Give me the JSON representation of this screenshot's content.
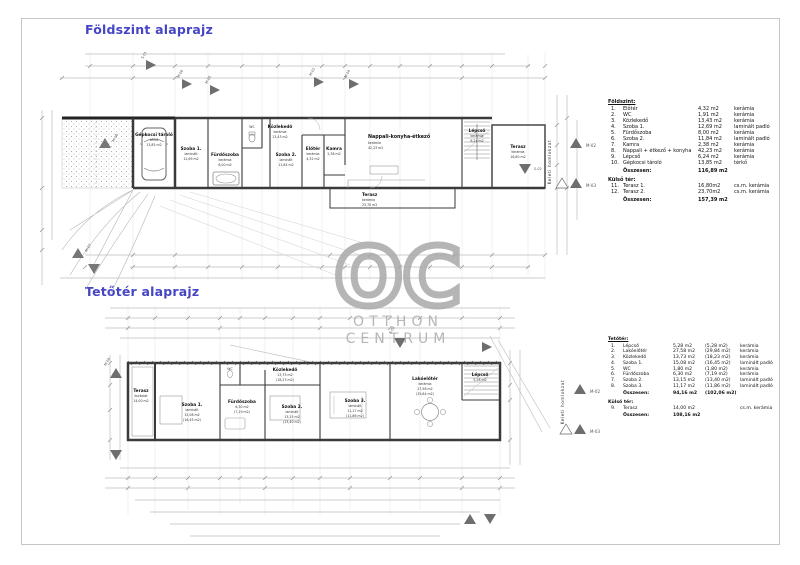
{
  "titles": {
    "ground": "Földszint alaprajz",
    "attic": "Tetőtér alaprajz"
  },
  "colors": {
    "title_blue": "#4545c5",
    "watermark_gray": "#a9a9a9",
    "wall_dark": "#3a3a3a",
    "dim_gray": "#b8b8b8"
  },
  "watermark": {
    "initials": "OC",
    "line1": "OTTHON",
    "line2": "CENTRUM"
  },
  "facade_label": "Keleti homlokzat",
  "markers": {
    "m01": "M-01",
    "m02": "M-02",
    "m03": "M-03",
    "m04": "M-04",
    "m05": "M-05",
    "m06": "M-06",
    "m07": "M-07",
    "m08": "M-08",
    "s01": "S-01",
    "s02": "S-02"
  },
  "ground_plan": {
    "rooms": {
      "gepkocsi": {
        "name": "Gépkocsi tároló",
        "mat": "térkő",
        "area": "13,85 m2"
      },
      "szoba1": {
        "name": "Szoba 1.",
        "mat": "laminált",
        "area": "12,69 m2"
      },
      "furdo": {
        "name": "Fürdőszoba",
        "mat": "kerámia",
        "area": "8,00 m2"
      },
      "wc": {
        "name": "WC",
        "area": "1,91 m2"
      },
      "kozlekedo": {
        "name": "Közlekedő",
        "mat": "kerámia",
        "area": "13,43 m2"
      },
      "szoba2": {
        "name": "Szoba 2.",
        "mat": "laminált",
        "area": "11,84 m2"
      },
      "eloter": {
        "name": "Előtér",
        "mat": "kerámia",
        "area": "4,32 m2"
      },
      "kamra": {
        "name": "Kamra",
        "area": "2,38 m2"
      },
      "nappali": {
        "name": "Nappali-konyha-étkező",
        "mat": "kerámia",
        "area": "42,23 m2"
      },
      "lepcso": {
        "name": "Lépcső",
        "mat": "kerámia",
        "area": "6,24 m2"
      },
      "terasz1": {
        "name": "Terasz",
        "mat": "kerámia",
        "area": "16,80 m2"
      },
      "terasz2": {
        "name": "Terasz",
        "mat": "kerámia",
        "area": "23,70 m2"
      }
    }
  },
  "attic_plan": {
    "rooms": {
      "terasz": {
        "name": "Terasz",
        "mat": "burkolat",
        "area": "14,00 m2"
      },
      "szoba1": {
        "name": "Szoba 1.",
        "mat": "laminált",
        "area": "15,08 m2",
        "paren": "(16,45 m2)"
      },
      "wc": {
        "name": "WC",
        "area": "1,80 m2"
      },
      "furdo": {
        "name": "Fürdőszoba",
        "mat": "kerámia",
        "area": "6,30 m2",
        "paren": "(7,19 m2)"
      },
      "szoba2": {
        "name": "Szoba 2.",
        "mat": "laminált",
        "area": "13,15 m2",
        "paren": "(13,40 m2)"
      },
      "szoba3": {
        "name": "Szoba 3.",
        "mat": "laminált",
        "area": "11,17 m2",
        "paren": "(11,86 m2)"
      },
      "kozlekedo": {
        "name": "Közlekedő",
        "area": "13,73 m2",
        "paren": "(18,23 m2)"
      },
      "lakoeloter": {
        "name": "Lakóelőtér",
        "mat": "kerámia",
        "area": "27,58 m2",
        "paren": "(29,84 m2)"
      },
      "lepcso": {
        "name": "Lépcső",
        "area": "5,28 m2"
      }
    }
  },
  "legend_ground": {
    "header": "Földszint:",
    "rows": [
      {
        "no": "1.",
        "name": "Előtér",
        "area": "4,32 m2",
        "mat": "kerámia"
      },
      {
        "no": "2.",
        "name": "WC",
        "area": "1,91 m2",
        "mat": "kerámia"
      },
      {
        "no": "3.",
        "name": "Közlekedő",
        "area": "13,43 m2",
        "mat": "kerámia"
      },
      {
        "no": "4.",
        "name": "Szoba 1.",
        "area": "12,69 m2",
        "mat": "laminált padló"
      },
      {
        "no": "5.",
        "name": "Fürdőszoba",
        "area": "8,00 m2",
        "mat": "kerámia"
      },
      {
        "no": "6.",
        "name": "Szoba 2.",
        "area": "11,84 m2",
        "mat": "laminált padló"
      },
      {
        "no": "7.",
        "name": "Kamra",
        "area": "2,38 m2",
        "mat": "kerámia"
      },
      {
        "no": "8.",
        "name": "Nappali + étkező + konyha",
        "area": "42,23 m2",
        "mat": "kerámia"
      },
      {
        "no": "9.",
        "name": "Lépcső",
        "area": "6,24 m2",
        "mat": "kerámia"
      },
      {
        "no": "10.",
        "name": "Gépkocsi tároló",
        "area": "13,85 m2",
        "mat": "térkő"
      }
    ],
    "sum_label": "Összesen:",
    "sum": "116,89 m2",
    "outdoor_header": "Külső tér:",
    "outdoor_rows": [
      {
        "no": "11.",
        "name": "Terasz 1.",
        "area": "16,80m2",
        "mat": "cs.m. kerámia"
      },
      {
        "no": "12.",
        "name": "Terasz 2.",
        "area": "23,70m2",
        "mat": "cs.m. kerámia"
      }
    ],
    "total_label": "Összesen:",
    "total": "157,39 m2"
  },
  "legend_attic": {
    "header": "Tetőtér:",
    "rows": [
      {
        "no": "1.",
        "name": "Lépcső",
        "area": "5,28 m2",
        "paren": "(5,28 m2)",
        "mat": "kerámia"
      },
      {
        "no": "2.",
        "name": "Lakóelőtér",
        "area": "27,58 m2",
        "paren": "(29,84 m2)",
        "mat": "kerámia"
      },
      {
        "no": "3.",
        "name": "Közlekedő",
        "area": "13,73 m2",
        "paren": "(18,23 m2)",
        "mat": "kerámia"
      },
      {
        "no": "4.",
        "name": "Szoba 1.",
        "area": "15,08 m2",
        "paren": "(16,45 m2)",
        "mat": "laminált padló"
      },
      {
        "no": "5.",
        "name": "WC",
        "area": "1,80 m2",
        "paren": "(1,80 m2)",
        "mat": "kerámia"
      },
      {
        "no": "6.",
        "name": "Fürdőszoba",
        "area": "6,30 m2",
        "paren": "(7,19 m2)",
        "mat": "kerámia"
      },
      {
        "no": "7.",
        "name": "Szoba 2.",
        "area": "13,15 m2",
        "paren": "(13,40 m2)",
        "mat": "laminált padló"
      },
      {
        "no": "8.",
        "name": "Szoba 3.",
        "area": "11,17 m2",
        "paren": "(11,86 m2)",
        "mat": "laminált padló"
      }
    ],
    "sum_label": "Összesen:",
    "sum": "94,16 m2",
    "sum_paren": "(102,06 m2)",
    "outdoor_header": "Külső tér:",
    "outdoor_rows": [
      {
        "no": "9.",
        "name": "Terasz",
        "area": "14,00 m2",
        "paren": "",
        "mat": "cs.m. kerámia"
      }
    ],
    "total_label": "Összesen:",
    "total": "108,16 m2"
  }
}
